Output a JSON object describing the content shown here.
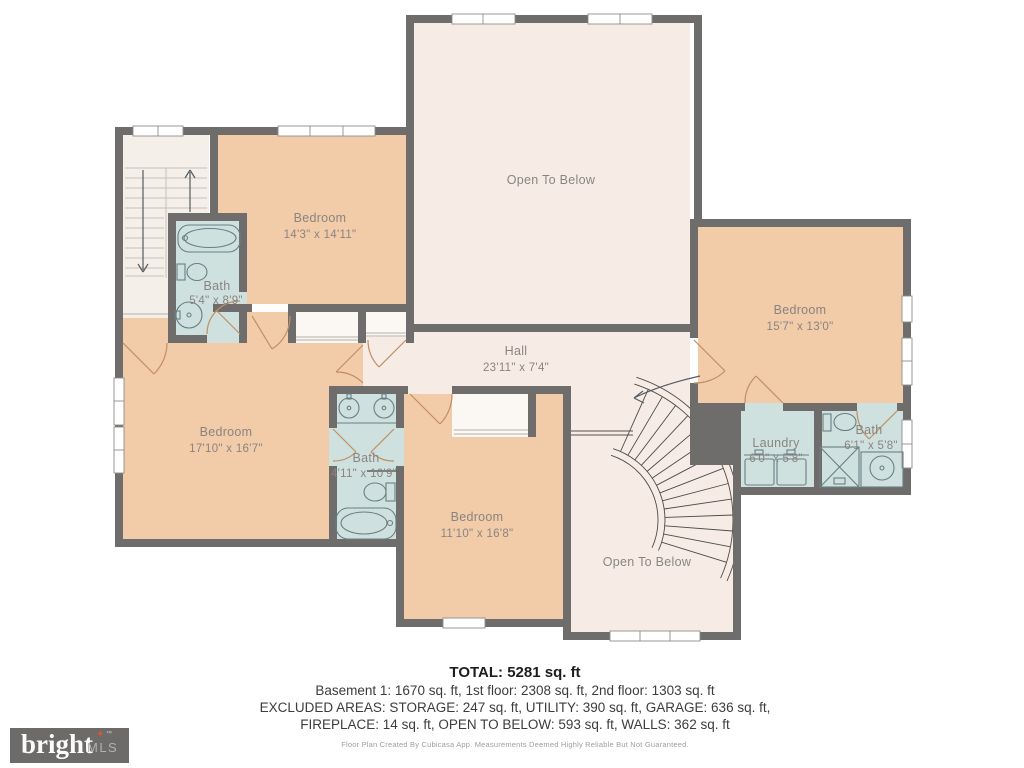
{
  "plan": {
    "rooms": {
      "open_below_top": {
        "name": "Open To Below"
      },
      "bedroom_top": {
        "name": "Bedroom",
        "dims": "14'3\" x 14'11\""
      },
      "bath_top_left": {
        "name": "Bath",
        "dims": "5'4\" x 8'9\""
      },
      "bedroom_right": {
        "name": "Bedroom",
        "dims": "15'7\" x 13'0\""
      },
      "hall": {
        "name": "Hall",
        "dims": "23'11\" x 7'4\""
      },
      "bedroom_left": {
        "name": "Bedroom",
        "dims": "17'10\" x 16'7\""
      },
      "bath_middle": {
        "name": "Bath",
        "dims": "4'11\" x 10'9\""
      },
      "bedroom_bottom": {
        "name": "Bedroom",
        "dims": "11'10\" x 16'8\""
      },
      "laundry": {
        "name": "Laundry",
        "dims": "6'0\" x 5'8\""
      },
      "bath_right": {
        "name": "Bath",
        "dims": "6'1\" x 5'8\""
      },
      "open_below_bottom": {
        "name": "Open To Below"
      }
    },
    "colors": {
      "wall": "#6e6d6b",
      "bedroom_fill": "#f2cba9",
      "bath_fill": "#cfe1df",
      "hall_fill": "#f6ece5",
      "closet_fill": "#fbf8f4",
      "label_text": "#8a8480",
      "door": "#bf8f63",
      "logo_bg": "#6c6b69",
      "logo_star": "#d9572b"
    }
  },
  "summary": {
    "total": "TOTAL: 5281 sq. ft",
    "line1": "Basement 1: 1670 sq. ft, 1st floor: 2308 sq. ft, 2nd floor: 1303 sq. ft",
    "line2": "EXCLUDED AREAS: STORAGE: 247 sq. ft, UTILITY: 390 sq. ft, GARAGE: 636 sq. ft,",
    "line3": "FIREPLACE: 14 sq. ft, OPEN TO BELOW: 593 sq. ft, WALLS: 362 sq. ft",
    "disclaimer": "Floor Plan Created By Cubicasa App. Measurements Deemed Highly Reliable But Not Guaranteed."
  },
  "logo": {
    "brand": "bright",
    "suffix": "MLS",
    "tm": "™",
    "star": "✦"
  }
}
